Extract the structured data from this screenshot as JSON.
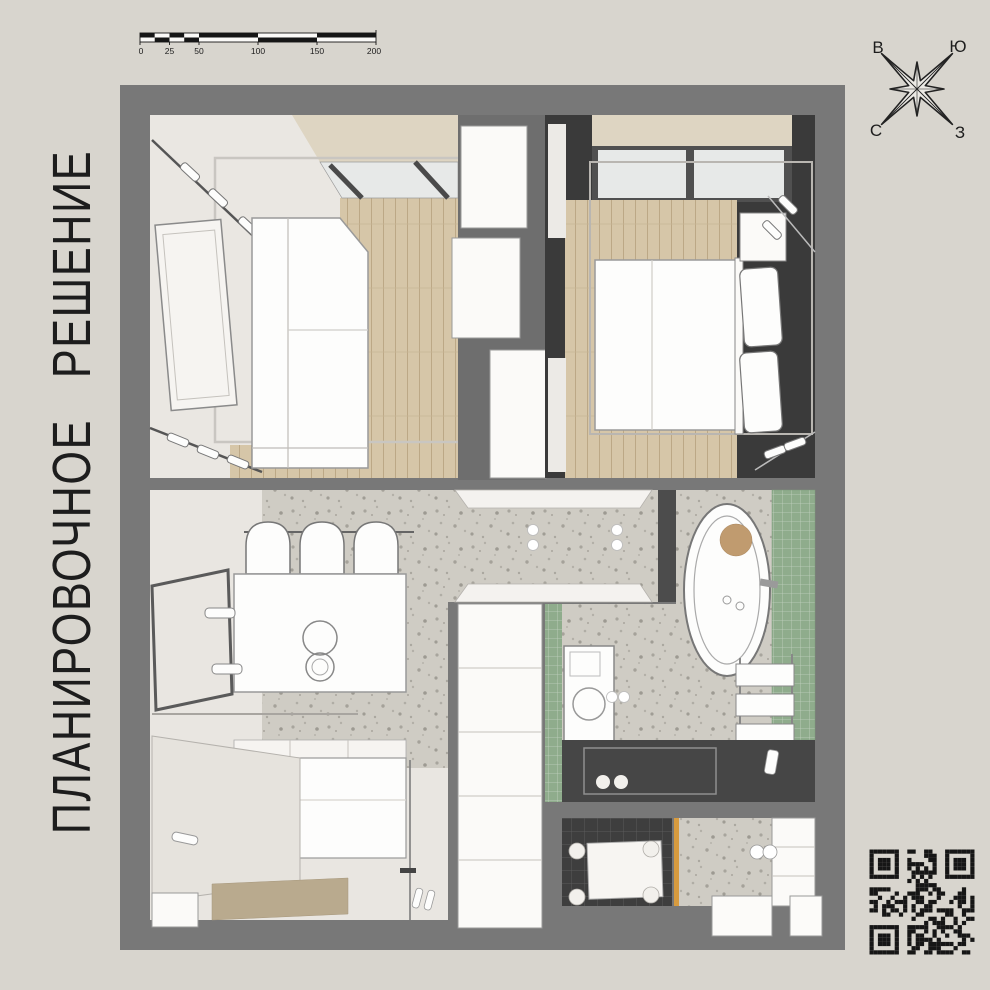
{
  "title": {
    "text": "ПЛАНИРОВОЧНОЕ РЕШЕНИЕ"
  },
  "scale_bar": {
    "labels": [
      "0",
      "25",
      "50",
      "100",
      "150",
      "200"
    ]
  },
  "compass": {
    "top_left": "В",
    "top_right": "Ю",
    "bottom_left": "С",
    "bottom_right": "З"
  },
  "colors": {
    "background": "#d8d5ce",
    "wall_gray": "#787878",
    "dark_wall": "#3a3a3a",
    "wardrobe_wall": "#6e6e6e",
    "wood_floor": "#d6c6a8",
    "terrazzo_floor": "#cfccc4",
    "cream_floor": "#eae7e2",
    "ceiling_band": "#ded5c2",
    "window_glass": "#e7e9e8",
    "green_tile": "#8fac8c",
    "dark_tile": "#3e3e3e",
    "shower_floor": "#464646",
    "accent_orange": "#d79b3f",
    "tub_headrest": "#c09b6f",
    "title_text": "#1d1d1d"
  }
}
